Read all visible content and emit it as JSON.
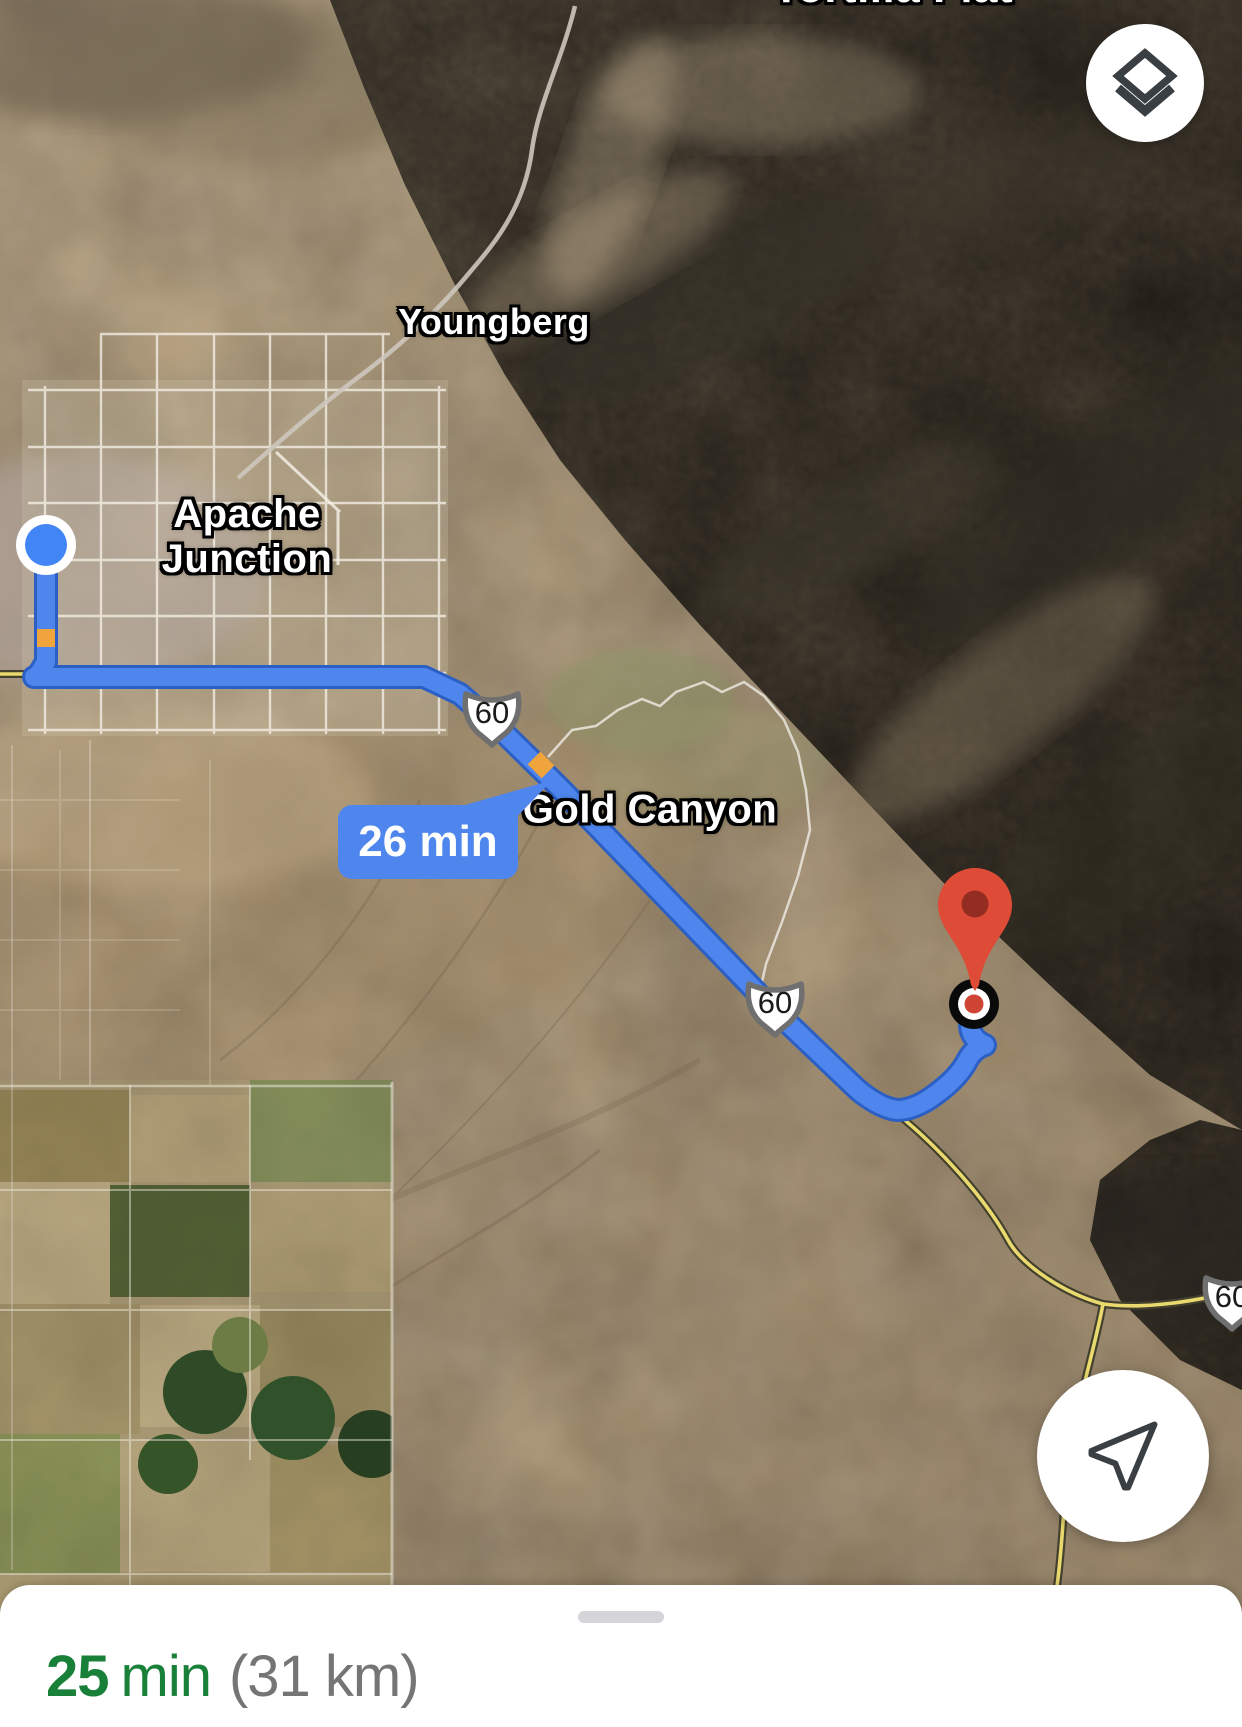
{
  "map": {
    "labels": {
      "tortilla_flat": "Tortilla Flat",
      "youngberg": "Youngberg",
      "apache_junction": "Apache Junction",
      "gold_canyon": "Gold Canyon"
    },
    "route": {
      "callout": "26 min",
      "shields": [
        {
          "label": "60"
        },
        {
          "label": "60"
        },
        {
          "label": "60"
        }
      ]
    },
    "icons": {
      "layers": "layers-icon",
      "locate": "navigation-arrow-icon"
    },
    "colors": {
      "route_blue": "#4e86ee",
      "route_casing": "#2c5fc4",
      "traffic_orange": "#f0a43c",
      "origin_blue": "#4285f4",
      "destination_red": "#de4b36"
    }
  },
  "bottom_sheet": {
    "duration": "25",
    "duration_unit": "min",
    "distance": "(31 km)",
    "duration_color": "#188038",
    "distance_color": "#757575"
  }
}
